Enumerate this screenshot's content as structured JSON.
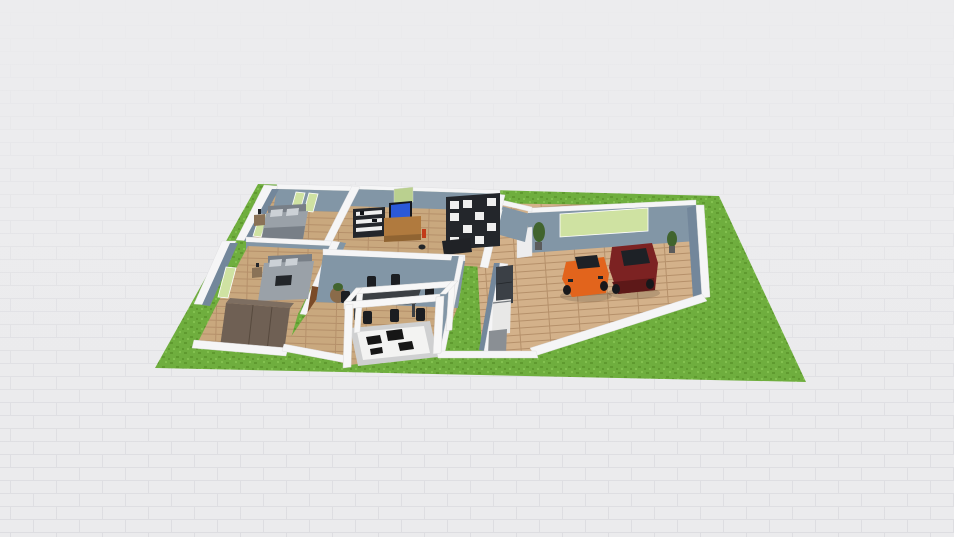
{
  "viewport": {
    "type": "3d-floorplan-render",
    "description": "isometric 3D floor plan of a house on a grass lot with attached garage, two cars, bedrooms, living room, dining area with pergola entrance, and kitchen"
  },
  "colors": {
    "bg": "#ebebed",
    "bg_line": "#dddde1",
    "grass": "#6fae3e",
    "grass_dark": "#5f9a2f",
    "grass_light": "#82c04f",
    "wood": "#c9a87e",
    "wood_line": "#b5906a",
    "wood_pale": "#d3b18a",
    "wall_top": "#f5f5f6",
    "wall_face": "#8296a6",
    "wall_face_dark": "#73879b",
    "glass": "#cfe2a2",
    "bed": "#9aa1a8",
    "bed_dark": "#787f87",
    "pillow": "#ccd1d6",
    "nightstand": "#8a7257",
    "wardrobe": "#6f6054",
    "wardrobe_top": "#7d6e61",
    "shelf_black": "#23262b",
    "shelf_white": "#efefef",
    "desk": "#b07a3e",
    "tv": "#14171d",
    "tv_screen": "#2b59d8",
    "tv_art": "#bad08f",
    "table": "#3c4044",
    "chair": "#1b1d21",
    "rug_pad": "#cfd0d1",
    "rug": "#f3f3f2",
    "rug_patch": "#161616",
    "door": "#7a4a28",
    "kitchen_dark": "#3b4046",
    "kitchen_mid": "#8a8f94",
    "kitchen_light": "#e8e8e7",
    "plant": "#41642e",
    "plant_pot": "#5b5b5b",
    "car_orange": "#e2641c",
    "car_red": "#7c2222",
    "car_red_dark": "#5d1818",
    "car_glass": "#1d2126",
    "tire": "#17181b",
    "pergola": "#f7f7f7",
    "white_unit": "#ededee",
    "accent_red": "#c23a18",
    "dark_object": "#23262a",
    "sofa": "#202226",
    "side_table": "#8a6b4a"
  },
  "objects": [
    "grass-lot",
    "tiled-ground",
    "garage",
    "garage-window",
    "sports-car",
    "sedan",
    "potted-plant-left",
    "potted-plant-right",
    "garage-cabinet",
    "entry-hall",
    "hall-window",
    "living-room",
    "wall-shelf",
    "tv",
    "tv-artwork",
    "tv-desk",
    "red-vase",
    "cube-bookshelf",
    "sofa",
    "pet",
    "bedroom-1",
    "bed-1",
    "nightstand-1",
    "bedroom-1-windows",
    "bedroom-2",
    "bed-2",
    "nightstand-2",
    "bedroom-2-window",
    "wardrobe",
    "interior-door",
    "dining-room",
    "dining-table",
    "dining-chairs",
    "round-side-table",
    "kitchen",
    "refrigerator",
    "kitchen-counter",
    "kitchen-cabinet",
    "entrance-pergola",
    "cowhide-rug"
  ]
}
